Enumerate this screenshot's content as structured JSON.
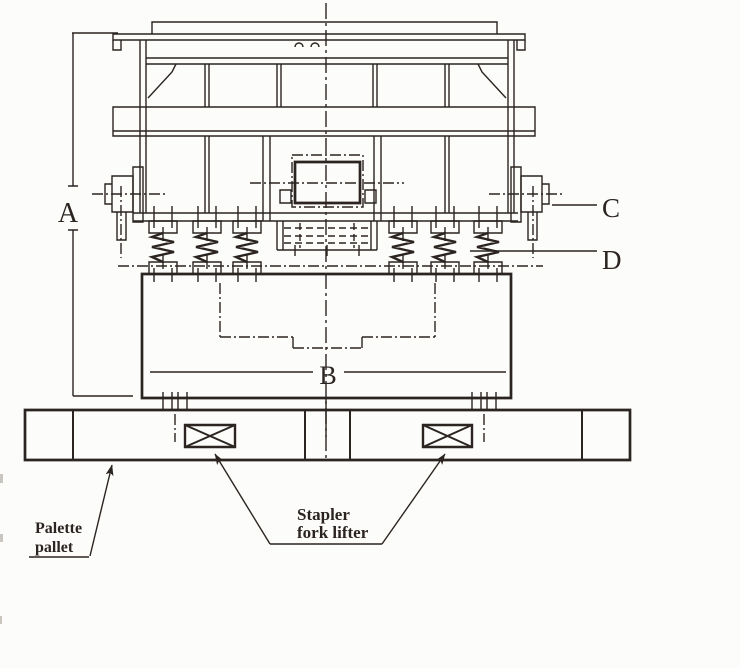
{
  "diagram": {
    "paper_color": "#fcfcfa",
    "ink_color": "#2b2420",
    "dim_labels": {
      "a": "A",
      "b": "B",
      "c": "C",
      "d": "D"
    },
    "annotations": {
      "pallet_label": {
        "line1": "Palette",
        "line2": "pallet"
      },
      "fork_lifter_label": {
        "line1": "Stapler",
        "line2": "fork lifter"
      }
    }
  }
}
